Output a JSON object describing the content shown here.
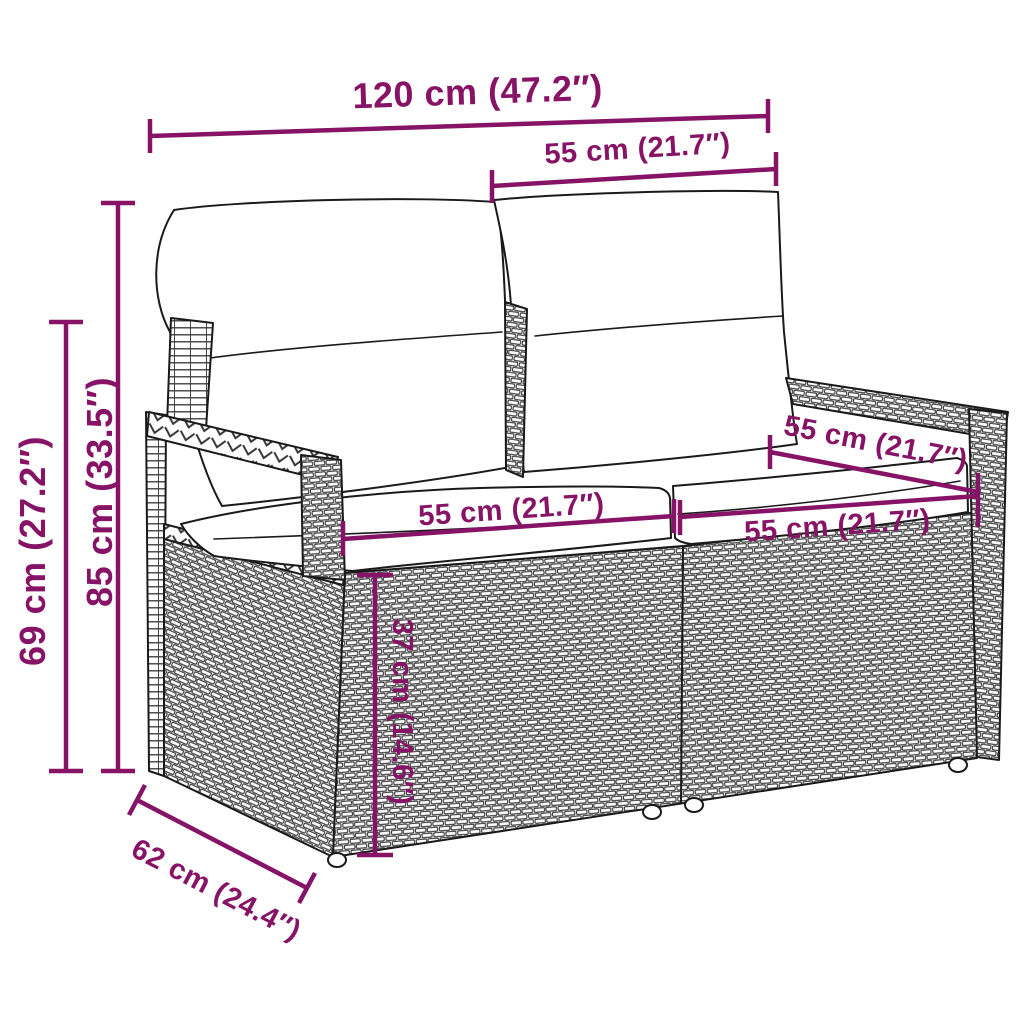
{
  "diagram": {
    "subject": "poly rattan two-seater garden sofa with cushions - dimension drawing",
    "background": "#ffffff"
  },
  "colors": {
    "dimension_annotation": "#871366",
    "line_art": "#1a1a1a"
  },
  "dims": {
    "d120": "120 cm (47.2″)",
    "d55_top": "55 cm (21.7″)",
    "d85": "85 cm (33.5″)",
    "d69": "69 cm (27.2″)",
    "d55_seat_left": "55 cm (21.7″)",
    "d55_seat_right": "55 cm (21.7″)",
    "d55_depth": "55 cm (21.7″)",
    "d37": "37 cm (14.6″)",
    "d62": "62 cm (24.4″)"
  }
}
